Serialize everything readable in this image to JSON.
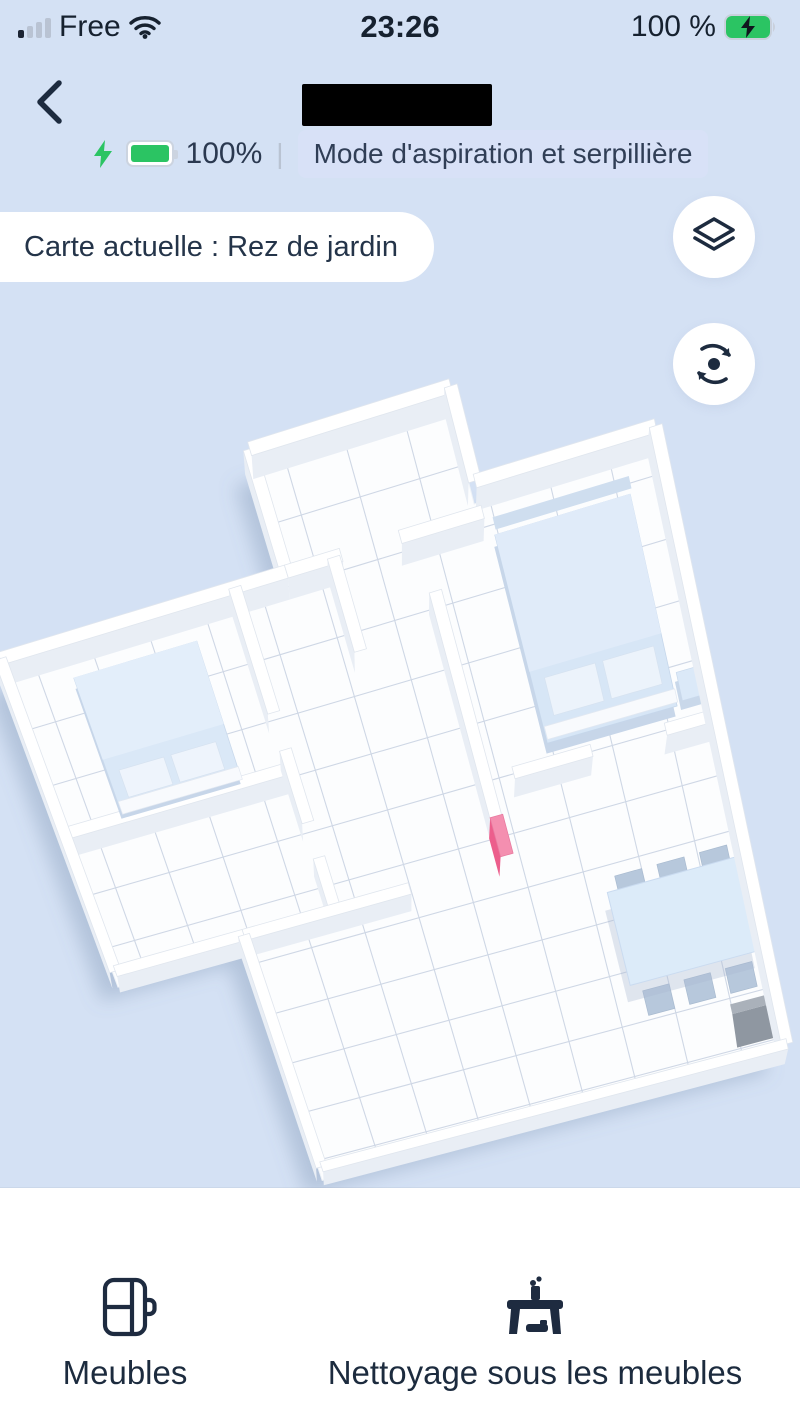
{
  "status_bar": {
    "carrier": "Free",
    "time": "23:26",
    "battery": "100 %"
  },
  "header": {
    "battery_percent": "100%",
    "divider": "|",
    "mode_badge": "Mode d'aspiration et serpillière"
  },
  "map": {
    "current_map_label": "Carte actuelle : Rez de jardin",
    "objects": [
      "bed",
      "bed",
      "nightstand",
      "dining-table",
      "chairs",
      "charging-dock",
      "virtual-wall-marker"
    ]
  },
  "bottom_bar": {
    "items": [
      {
        "label": "Meubles"
      },
      {
        "label": "Nettoyage sous les meubles"
      }
    ]
  },
  "colors": {
    "background": "#d4e1f4",
    "ink": "#1d2b3f",
    "battery_green": "#2bc463",
    "badge_bg": "#d8e1f7",
    "marker_pink": "#ee5f8c"
  }
}
